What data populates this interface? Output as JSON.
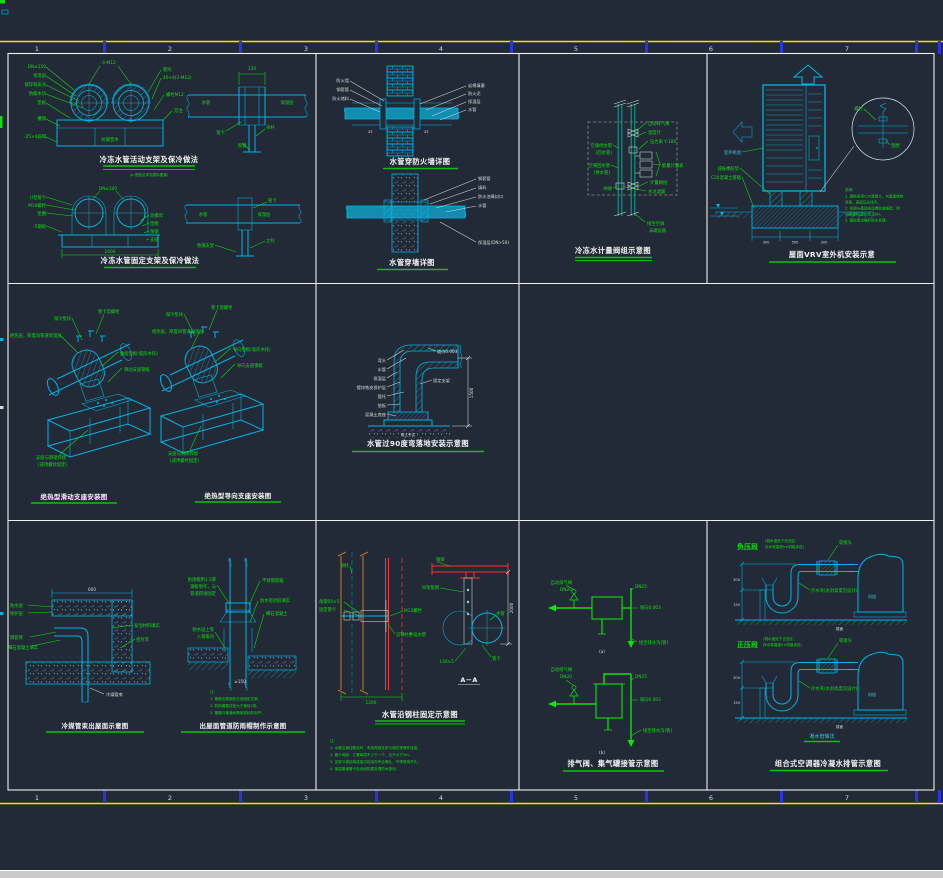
{
  "window": {
    "type": "CAD drawing viewport",
    "colors": {
      "background": "#212A36",
      "frame_white": "#EFEFEF",
      "line_cyan": "#00B4E6",
      "annotation_green": "#10E010",
      "ruler_yellow": "#E8E800",
      "tick_blue": "#2A35E0",
      "highlight_red": "#FF3030",
      "column_orange": "#B5782D",
      "pipe_teal": "#00A38C",
      "dashed_gray": "#8A8A8A",
      "footer_bar": "#C9C9C9"
    }
  },
  "ruler": {
    "numbers": [
      "1",
      "2",
      "3",
      "4",
      "5",
      "6",
      "7"
    ]
  },
  "panels": {
    "supports": {
      "title_a": "冷冻水管活动支架及保冷做法",
      "subtitle_a": "(a-型做法详见国标图集)",
      "title_b": "冷冻水管固定支架及保冷做法",
      "labels": {
        "a_dn": "DN≤150",
        "a_ins": "保温层",
        "a_shell": "镀锌铁皮壳",
        "a_wood": "防腐木块",
        "a_pad": "垫板",
        "a_channel": "槽钢",
        "a_flat": "-25×4扁钢",
        "a_bolt": "4-M12",
        "a_clamp": "管壳",
        "a_band": "40×4(2-M12)",
        "a_screw": "螺栓M12",
        "a_note": "见注",
        "a_block": "防腐垫木",
        "b_dim": "150",
        "b_pipe": "水管",
        "b_ins": "保温层",
        "b_clamp": "管卡",
        "b_rod": "吊杆",
        "b_steel": "角钢",
        "c_u": "U型管卡",
        "c_bolt": "M10螺栓",
        "c_washer": "垫圈",
        "c_plate": "-5钢板",
        "c_dn": "DN≤100",
        "c_nut": "双螺母",
        "c_w2": "垫圈",
        "c_angle": "角钢",
        "c_seat": "支座",
        "c_dim": "1000",
        "d_pipe": "水管",
        "d_ins": "保温层",
        "d_clamp": "管卡",
        "d_bracket": "角钢支架",
        "d_post": "立柱"
      }
    },
    "wall": {
      "title_a": "水管穿防火墙详图",
      "title_b": "水管穿墙详图",
      "labels": {
        "a_l1": "防火墙",
        "a_l2": "钢套管",
        "a_l3": "防火堵料",
        "a_r1": "岩棉填塞",
        "a_r2": "防火泥",
        "a_r3": "保温层",
        "a_r4": "水管",
        "a_d1": "25",
        "a_d2": "25",
        "b_r1": "钢套管",
        "b_r2": "填料",
        "b_r3": "防水油膏封口",
        "b_r4": "水管",
        "b_r5": "保温层(DN>50)"
      }
    },
    "meter": {
      "title": "冷冻水计量阀组示意图",
      "labels": {
        "l1": "空调供水管",
        "l2": "(回水管)",
        "l3": "空调回水管",
        "l4": "(供水管)",
        "l5": "闸阀",
        "r1": "自动排气阀",
        "r2": "压力表 Y-100",
        "r3": "温度计",
        "r4": "能量计量表",
        "r5": "计量阀组",
        "r6": "水过滤器",
        "b1": "接至空调",
        "b2": "末端设备"
      }
    },
    "vrv": {
      "title": "屋面VRV室外机安装示意",
      "labels": {
        "unit": "室外机组",
        "damper": "减振橡胶垫",
        "base": "C20混凝土基础",
        "d1": "300",
        "d2": "500",
        "d3": "300",
        "bolt": "螺栓",
        "washer": "垫圈",
        "n0": "说明：",
        "n1": "1. 基础采用C20混凝土，与屋面结构",
        "n2": "   连接，表面压光找平。",
        "n3": "2. 机组与基础间设橡胶减振垫，用",
        "n4": "   地脚螺栓固定(见大样)。",
        "n5": "3. 基础周边做好防水处理。"
      }
    },
    "saddle": {
      "title_a": "绝热型滑动支座安装图",
      "title_b": "绝热型导向支座安装图",
      "labels": {
        "a1": "保冷垫块",
        "a2": "管卡及螺栓",
        "a3": "绝热层，厚度同管道保温层",
        "a4": "曲面垫板(弧形木托)",
        "a5": "滑动支座钢板",
        "a6": "支座与钢梁焊接",
        "a7": "(或用螺栓固定)",
        "b1": "保冷垫块",
        "b2": "管卡及螺栓",
        "b3": "绝热层，厚度同管道保温层",
        "b4": "导向垫板(弧形木托)",
        "b5": "导向支座钢板",
        "b6": "支座与钢梁焊接",
        "b7": "(或用螺栓固定)"
      }
    },
    "elbow": {
      "title": "水管过90度弯落地安装示意图",
      "labels": {
        "l1": "弯头",
        "l2": "水管",
        "l3": "保温层",
        "l4": "镀锌铁皮保护层",
        "l5": "管托",
        "l6": "垫板",
        "l7": "混凝土底座",
        "r1": "坡向0.003",
        "r2": "固定支架",
        "dim": "1500",
        "g": "素土夯实"
      }
    },
    "roof_pipe": {
      "title_a": "冷媒管束出屋面示意图",
      "title_b": "出屋面管道防雨帽制作示意图",
      "labels": {
        "a_l1": "防水层",
        "a_l2": "保护层",
        "a_l3": "钢套管",
        "a_l4": "细石混凝土填实",
        "a_r1": "发泡材料填实",
        "a_r2": "密封膏",
        "a_dim": "600",
        "a_pipe": "冷媒管束",
        "b_l1": "防雨帽用1.5厚",
        "b_l2": "钢板制作，与",
        "b_l3": "管道焊接固定",
        "b_r1": "不锈钢管箍",
        "b_r2": "防水密封胶填实",
        "b_r3": "细石混凝土",
        "b_l4": "防水层上卷",
        "b_l5": "入管箍内",
        "b_dim": "≥150",
        "n0": "注：",
        "n1": "1. 管道出屋面处应设固定支架。",
        "n2": "2. 防雨帽直径宜大于管径2倍。",
        "n3": "3. 管箍与管道间隙用密封胶封严。"
      }
    },
    "column": {
      "title": "水管沿钢柱固定示意图",
      "labels": {
        "col": "钢柱",
        "angle": "角钢50×5",
        "clamp": "固定管卡",
        "bolt": "M12螺栓",
        "run": "沿钢柱敷设水管",
        "dim1": "1200",
        "beam": "钢梁",
        "hanger": "吊架角钢",
        "pipe": "水管",
        "clamp2": "管卡",
        "l50": "L50×5",
        "dim2": "2000",
        "section": "A－A",
        "n0": "注：",
        "n1": "1. 水管沿钢柱敷设时，采用角钢支架与钢柱预埋件连接。",
        "n2": "2. 管卡间距：立管每层不少于一个，且不大于2m。",
        "n3": "3. 支架与钢结构连接应经结构专业确认，不得现场开孔。",
        "n4": "4. 保温管道管卡处设经防腐处理的木垫块。"
      }
    },
    "airvent": {
      "title": "排气阀、集气罐接管示意图",
      "labels": {
        "a_v1": "自动排气阀",
        "a_v2": "DN20",
        "a_dn": "DN25",
        "a_slope": "坡向0.003",
        "a_drain": "接至排水沟(管)",
        "a_cap": "(a)",
        "b_v1": "自动排气阀",
        "b_v2": "DN20",
        "b_dn": "DN25",
        "b_slope": "坡向0.003",
        "b_drain": "接至排水沟(管)",
        "b_cap": "(b)"
      }
    },
    "condensate": {
      "title": "组合式空调器冷凝水排管示意图",
      "subtitle": "凝水管做法",
      "labels": {
        "neg": "负压段",
        "neg_s1": "(凝水盘处于负压区，",
        "neg_s2": "存水弯高度h≥机组余压)",
        "pos": "正压段",
        "pos_s1": "(凝水盘处于正压区，",
        "pos_s2": "存水弯高度h≥机组余压)",
        "joint1": "软接头",
        "trap1": "存水弯(水封高度见设计)",
        "unit1": "机组",
        "floor1": "楼面",
        "joint2": "软接头",
        "trap2": "存水弯(水封高度见设计)",
        "unit2": "机组",
        "floor2": "楼面",
        "d1": "300",
        "d2": "150",
        "d3": "300",
        "d4": "150"
      }
    }
  }
}
